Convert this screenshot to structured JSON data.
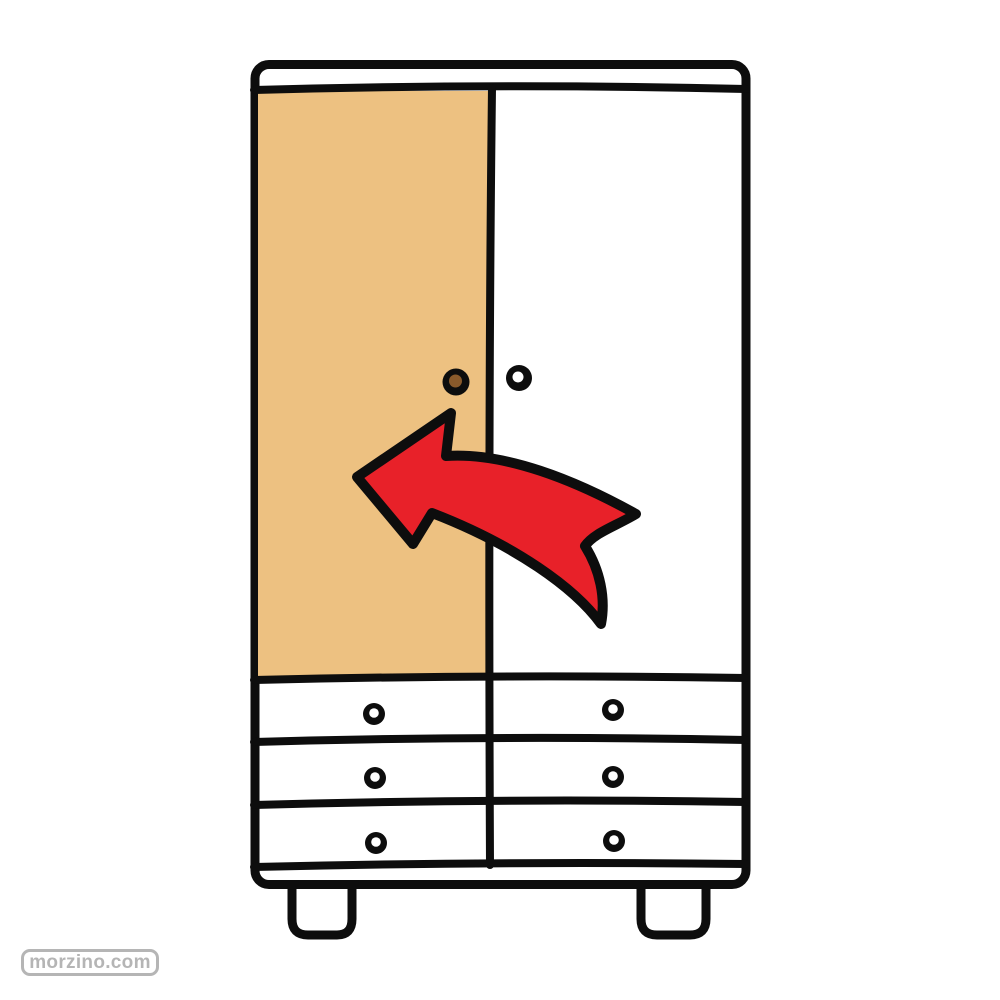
{
  "illustration": {
    "subject": "wardrobe",
    "left_door": {
      "label": "left door",
      "highlighted": true
    },
    "right_door": {
      "label": "right door",
      "highlighted": false
    },
    "arrow": {
      "direction": "left",
      "points_at": "left door"
    },
    "drawers": {
      "rows": 3,
      "columns": 2,
      "count": 6
    }
  },
  "watermark": {
    "text": "morzino.com"
  },
  "colors": {
    "outline-black": "#0d0d0d",
    "surface-white": "#ffffff",
    "door-highlight": "#edc181",
    "arrow-red": "#e82129",
    "knob-brown": "#8a5a2b",
    "watermark-gray": "#b5b5b5"
  }
}
